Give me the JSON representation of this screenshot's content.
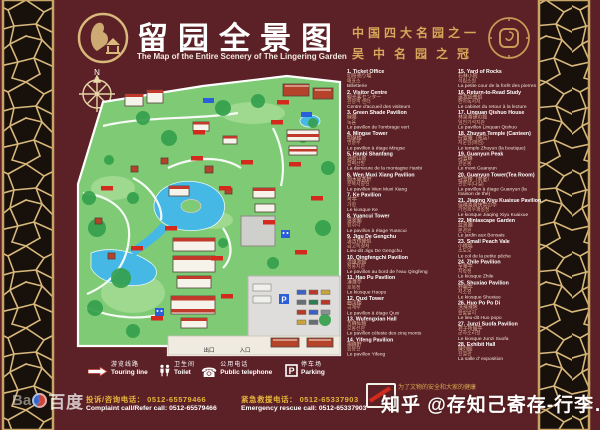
{
  "header": {
    "title_cn": "留园全景图",
    "title_en": "The Map of the Entire Scenery of The Lingering Garden",
    "honor_line1": "中国四大名园之一",
    "honor_line2": "吴中名园之冠"
  },
  "map": {
    "compass_label": "N",
    "exit_label": "出口",
    "entrance_label": "入口",
    "parking_mark": "P"
  },
  "legend": {
    "columns": [
      [
        {
          "num": "1.",
          "en": "Ticket Office",
          "jp": "切符売り場",
          "kr": "매표소",
          "fr": "Billetterie"
        },
        {
          "num": "2.",
          "en": "Visitor Centre",
          "jp": "観光客センター",
          "kr": "관광객 센터",
          "fr": "Centre d'accueil des visiteurs"
        },
        {
          "num": "3.",
          "en": "Green Shade Pavilion",
          "jp": "緑蔭",
          "kr": "녹음",
          "fr": "Le pavillon de l'ombrage vert"
        },
        {
          "num": "4.",
          "en": "Mingse Tower",
          "jp": "明瑟楼",
          "kr": "명슬루",
          "fr": "Le pavillon à étage Mingse"
        },
        {
          "num": "5.",
          "en": "Hanbi Shanfang",
          "jp": "涵碧山房",
          "kr": "함벽산방",
          "fr": "La demeure de la montagne Hanbi"
        },
        {
          "num": "6.",
          "en": "Wen Muxi Xiang Pavilion",
          "jp": "聞木犀香軒",
          "kr": "문목서향헌",
          "fr": "Le pavillon Wen Muxi Xiang"
        },
        {
          "num": "7.",
          "en": "Ke Pavilion",
          "jp": "可亭",
          "kr": "가정",
          "fr": "Le kiosque Ke"
        },
        {
          "num": "8.",
          "en": "Yuancui Tower",
          "jp": "遠翠閣",
          "kr": "원취각",
          "fr": "Le pavillon à étage Yuancui"
        },
        {
          "num": "9.",
          "en": "Jigu De Gengchu",
          "jp": "汲古得綆処",
          "kr": "급고득경처",
          "fr": "Lieu-dit Jigu De Gengchu"
        },
        {
          "num": "10.",
          "en": "Qingfengchi Pavilion",
          "jp": "清風池館",
          "kr": "청풍지관",
          "fr": "Le pavillon au bord de l'eau Qingfeng"
        },
        {
          "num": "11.",
          "en": "Hao Pu Pavilion",
          "jp": "濠濮亭",
          "kr": "호복정",
          "fr": "Le kiosque Haopu"
        },
        {
          "num": "12.",
          "en": "Quxi Tower",
          "jp": "曲渓楼",
          "kr": "곡계루",
          "fr": "Le pavillon à étage Quxi"
        },
        {
          "num": "13.",
          "en": "Wufengxian Hall",
          "jp": "五峰仙館",
          "kr": "오봉선관",
          "fr": "Le pavillon céleste des cinq monts"
        },
        {
          "num": "14.",
          "en": "Yifeng Pavilion",
          "jp": "揖峰軒",
          "kr": "읍봉헌",
          "fr": "Le pavillon Yifeng"
        }
      ],
      [
        {
          "num": "15.",
          "en": "Yard of Rocks",
          "jp": "石林小院",
          "kr": "석림소원",
          "fr": "La petite cour de la forêt des pierres"
        },
        {
          "num": "16.",
          "en": "Return-to-Read Study",
          "jp": "還我読書処",
          "kr": "환아독서처",
          "fr": "Le cabinet du retour à la lecture"
        },
        {
          "num": "17.",
          "en": "Linquan Qishuo House",
          "jp": "林泉耆碩の館",
          "kr": "임천기석지관",
          "fr": "Le pavillon Linquan Qishuo"
        },
        {
          "num": "18.",
          "en": "Zhuyun Temple (Canteen)",
          "jp": "佇雲庵（売店）",
          "kr": "저운암(매점)",
          "fr": "Le temple Zhuyun (la boutique)"
        },
        {
          "num": "19.",
          "en": "Guanyun Peak",
          "jp": "冠雲峰",
          "kr": "관운봉",
          "fr": "Le mont Guanyun"
        },
        {
          "num": "20.",
          "en": "Guanyun Tower(Tea Room)",
          "jp": "冠雲楼（茶室）",
          "kr": "관운루(다실)",
          "fr": "Le pavillon à étage Guanyun (la maison de thé)"
        },
        {
          "num": "21.",
          "en": "Jiaqing Xiyu Kuaixue Pavilion",
          "jp": "佳晴喜雨快雪の亭",
          "kr": "가청희우쾌설정",
          "fr": "Le kiosque Jiaqing Xiyu Kuaixue"
        },
        {
          "num": "22.",
          "en": "Miniascape Garden",
          "jp": "盆景園",
          "kr": "분경원",
          "fr": "Le jardin aux Bonsais"
        },
        {
          "num": "23.",
          "en": "Small Peach Vale",
          "jp": "小桃塢",
          "kr": "소도오",
          "fr": "Le col de la petite pêche"
        },
        {
          "num": "24.",
          "en": "Zhile Pavilion",
          "jp": "至楽亭",
          "kr": "지락정",
          "fr": "Le kiosque Zhile"
        },
        {
          "num": "25.",
          "en": "Shuxiao Pavilion",
          "jp": "舒嘯亭",
          "kr": "서소정",
          "fr": "Le kiosque Shuxiao"
        },
        {
          "num": "26.",
          "en": "Huo Po Po Di",
          "jp": "活溌溌地",
          "kr": "활발발지",
          "fr": "Le lieu-dit Huo popo"
        },
        {
          "num": "27.",
          "en": "Junzi Suofa Pavilion",
          "jp": "君子所履亭",
          "kr": "군자소리정",
          "fr": "Le kiosque Junzi Suofa"
        },
        {
          "num": "28.",
          "en": "Exhibit Hall",
          "jp": "陳列館",
          "kr": "진열관",
          "fr": "La salle d' exposition"
        }
      ]
    ]
  },
  "facilities": [
    {
      "icon": "touring-line",
      "cn": "游览线路",
      "en": "Touring line"
    },
    {
      "icon": "toilet",
      "cn": "卫生间",
      "en": "Toilet"
    },
    {
      "icon": "telephone",
      "cn": "公用电话",
      "en": "Public telephone"
    },
    {
      "icon": "parking",
      "cn": "停车场",
      "en": "Parking"
    }
  ],
  "hotlines": {
    "complaint_cn": "投诉/咨询电话：  0512-65579466",
    "complaint_en": "Complaint call/Refer call: 0512-65579466",
    "emergency_cn": "紧急救援电话：  0512-65337903",
    "emergency_en": "Emergency rescue call: 0512-65337903"
  },
  "notice": "为了文物的安全和大家的健康",
  "watermarks": {
    "baidu_latin": "Ba",
    "baidu_cn": "百度",
    "zhihu": "知乎 @存知己寄存-行李…"
  },
  "colors": {
    "board_maroon": "#5c2126",
    "lattice_gold": "#d8b77a",
    "title_white": "#ffffff",
    "honor_gold": "#d8a75a",
    "map_green": "#7fca75",
    "water_blue": "#45b8e6",
    "label_red": "#d42a1e",
    "hotline_gold": "#e5b23c"
  }
}
